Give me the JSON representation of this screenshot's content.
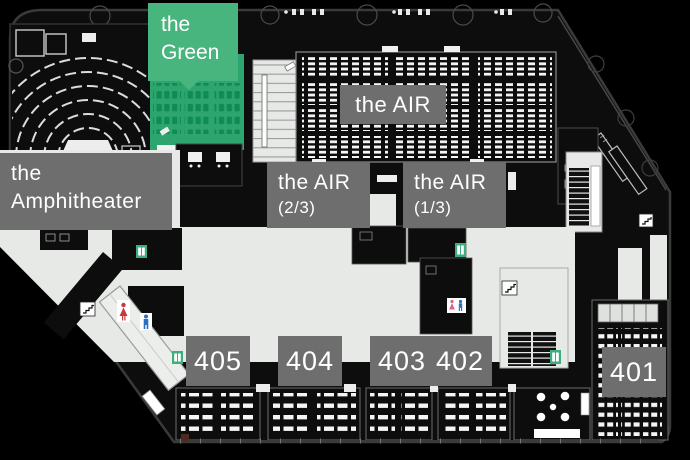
{
  "floor_map": {
    "rooms": {
      "green": {
        "name_line1": "the",
        "name_line2": "Green"
      },
      "air": {
        "name": "the AIR"
      },
      "air_2_3": {
        "name_line1": "the AIR",
        "name_line2": "(2/3)"
      },
      "air_1_3": {
        "name_line1": "the AIR",
        "name_line2": "(1/3)"
      },
      "amphitheater": {
        "name_line1": "the",
        "name_line2": "Amphitheater"
      },
      "room_405": {
        "number": "405"
      },
      "room_404": {
        "number": "404"
      },
      "room_403": {
        "number": "403"
      },
      "room_402": {
        "number": "402"
      },
      "room_401": {
        "number": "401"
      }
    },
    "colors": {
      "background": "#000000",
      "floor": "#0D0D0D",
      "concourse_gray": "#E7E9E7",
      "label_gray": "#6E6E6E",
      "label_text": "#FFFFFF",
      "green_label": "#48B57E",
      "green_room": "#2EA56E",
      "green_seat": "#0F8B54",
      "seat_white": "#F5F5F5",
      "restroom_woman_red": "#C9383F",
      "restroom_man_blue": "#2C6FC4",
      "elevator_green": "#3CAF7C"
    },
    "icons": {
      "elevator": "elevator-icon",
      "escalator": "escalator-icon",
      "restroom_woman": "restroom-woman-icon",
      "restroom_man": "restroom-man-icon",
      "restroom_pair": "restroom-icon"
    }
  }
}
